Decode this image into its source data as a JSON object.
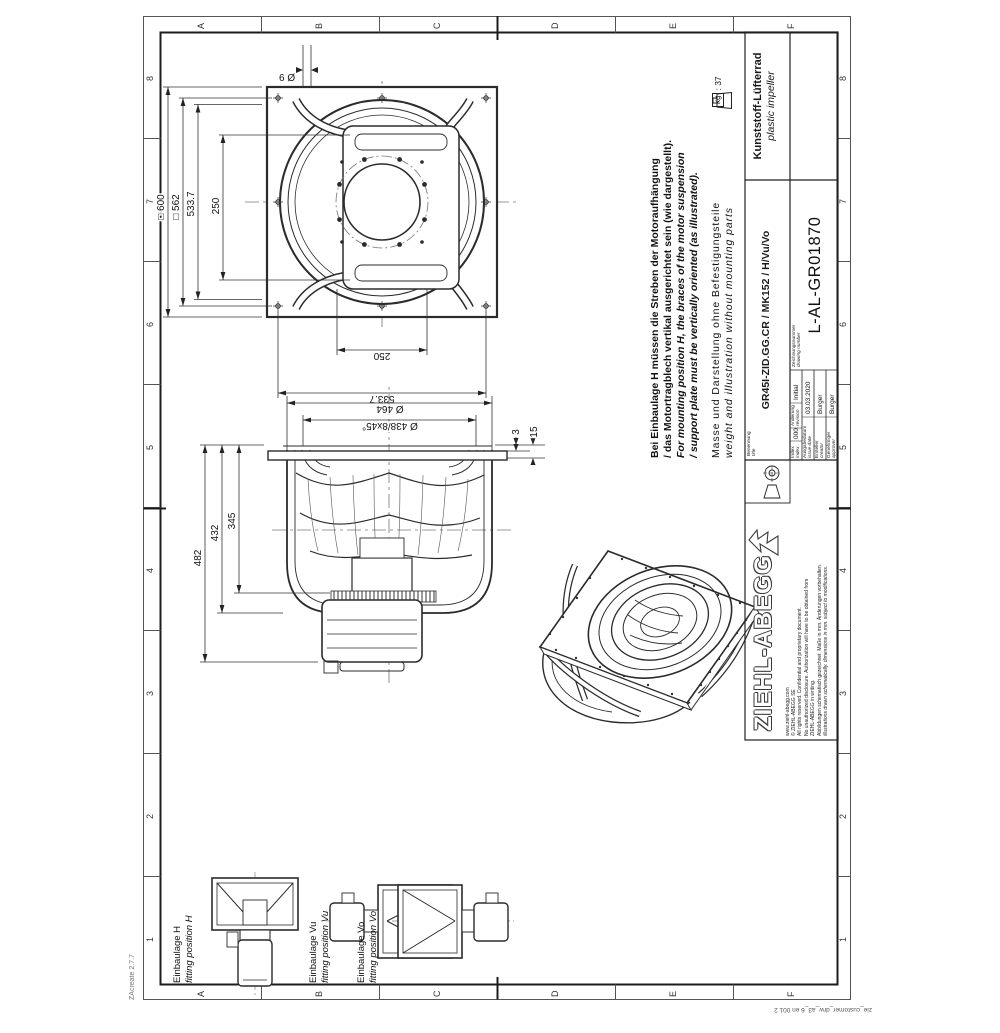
{
  "sheet": {
    "col_labels": [
      "1",
      "2",
      "3",
      "4",
      "5",
      "6",
      "7",
      "8"
    ],
    "row_labels": [
      "A",
      "B",
      "C",
      "D",
      "E",
      "F"
    ],
    "version": "ZAcreate 2.7.7",
    "form_id": "zie_customer_drw_a3_6 en 001 2"
  },
  "front_view": {
    "dims": {
      "sq600": "□ 600",
      "sq562": "□ 562",
      "d5337_top": "533.7",
      "d250_top": "250",
      "d5337_left": "533.7",
      "d250_left": "250",
      "hole": "6 Ø"
    }
  },
  "section_view": {
    "dims": {
      "d482": "482",
      "d432": "432",
      "d345": "345",
      "d464": "Ø 464",
      "d438": "Ø 438/8x45°",
      "t3": "3",
      "t15": "15"
    }
  },
  "notes": {
    "de1": "Bei Einbaulage H müssen die Streben der Motoraufhängung",
    "de2": "/ das Motortragblech vertikal ausgerichtet sein (wie dargestellt).",
    "en1": "For mounting position H, the braces of the motor suspension",
    "en2": "/ support plate must be vertically oriented (as illustrated).",
    "mass_de": "Masse und Darstellung ohne Befestigungsteile",
    "mass_en": "weight and illustration without mounting parts"
  },
  "fitting": {
    "h_de": "Einbaulage H",
    "h_en": "fitting position H",
    "vu_de": "Einbaulage Vu",
    "vu_en": "fitting position Vu",
    "vo_de": "Einbaulage Vo",
    "vo_en": "fitting position Vo"
  },
  "weight": {
    "label": "kg",
    "sep": ":",
    "value": "37"
  },
  "title_block": {
    "benennung_label": "Benennung",
    "benennung_label_en": "title",
    "part_code": "GR45I-ZID.GG.CR / MK152 / H/Vu/Vo",
    "name_de": "Kunststoff-Lüfterrad",
    "name_en": "plastic impeller",
    "index_label": "Index",
    "index_label_en": "index",
    "index_value": "000",
    "revision_label": "Änderung",
    "revision_label_en": "revision",
    "revision_value": "Initial",
    "date_label": "Ausgabedatum",
    "date_label_en": "issue date",
    "date_value": "03.03.2020",
    "creator_label": "Ersteller",
    "creator_label_en": "creator",
    "creator_value": "Burger",
    "approver_label": "Genehmiger",
    "approver_label_en": "approver",
    "approver_value": "Burger",
    "dwg_label": "Zeichnungsnummer",
    "dwg_label_en": "drawing number",
    "drawing_number": "L-AL-GR01870"
  },
  "logo_block": {
    "brand": "ZIEHL-ABEGG",
    "c1": "www.ziehl-abegg.com",
    "c2": "© ZIEHL-ABEGG SE",
    "c3": "All rights reserved. Confidential and proprietary document.",
    "c4": "No unauthorized disclosure. Authorization will have to be obtained from",
    "c5": "ZIEHL-ABEGG in writing.",
    "note_de": "Abbildungen schematisch gezeichnet. Maße in mm. Änderungen vorbehalten.",
    "note_en": "illustrations drawn schematically. dimensions in mm. subject to modifications."
  }
}
